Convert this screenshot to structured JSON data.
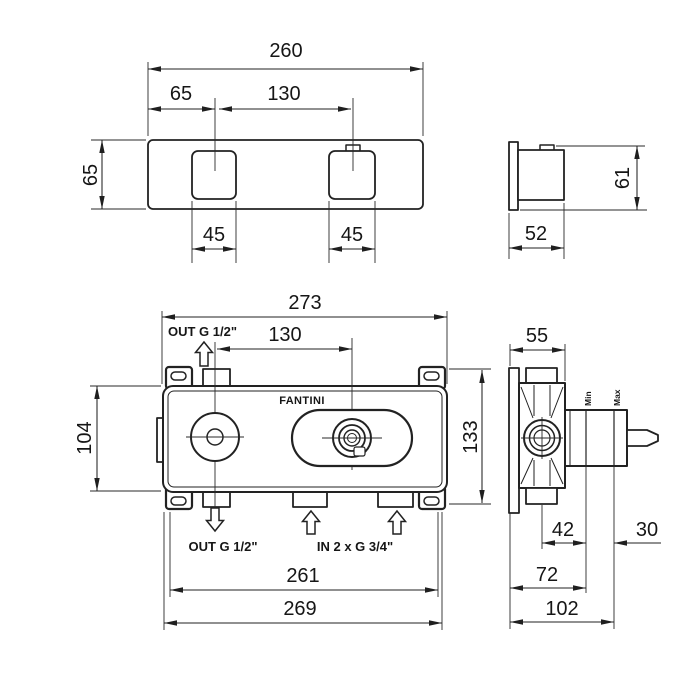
{
  "drawing_type": "faucet rough-in technical drawing",
  "trim_front": {
    "width": "260",
    "offset": "65",
    "spacing": "130",
    "height": "65",
    "handle_left": "45",
    "handle_right": "45"
  },
  "trim_side": {
    "depth": "52",
    "height": "61"
  },
  "rough_front": {
    "brand": "FANTINI",
    "width": "273",
    "spacing": "130",
    "out_top": "OUT G 1/2\"",
    "out_bottom": "OUT G 1/2\"",
    "inlets": "IN 2 x G 3/4\"",
    "height_body": "104",
    "height_overall": "133",
    "width_ports": "261",
    "width_overall": "269"
  },
  "rough_side": {
    "depth": "55",
    "min": "Min",
    "max": "Max",
    "center_to_min": "42",
    "min_to_max": "30",
    "depth_min": "72",
    "depth_max": "102"
  }
}
